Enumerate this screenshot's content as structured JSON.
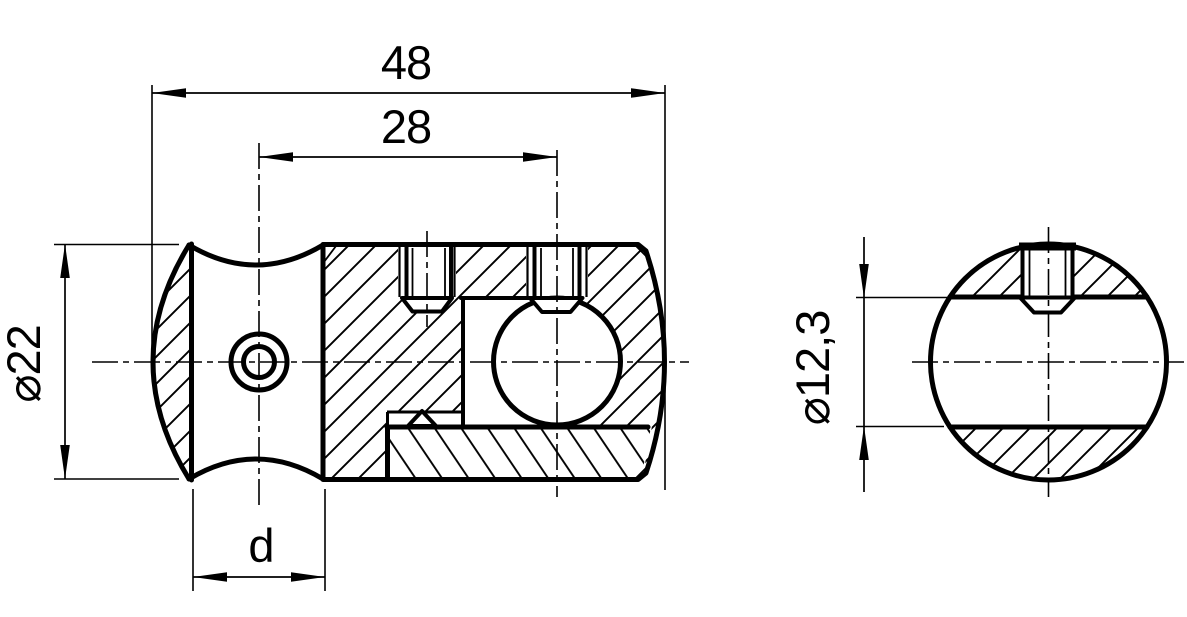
{
  "drawing": {
    "type": "technical-drawing",
    "part": "cross connector with set screws",
    "colors": {
      "background": "#ffffff",
      "line": "#000000"
    },
    "labels": {
      "overall_length": "48",
      "center_distance": "28",
      "rod_seat_width": "d",
      "body_diameter": "⌀22",
      "bore_diameter": "⌀12,3"
    }
  }
}
